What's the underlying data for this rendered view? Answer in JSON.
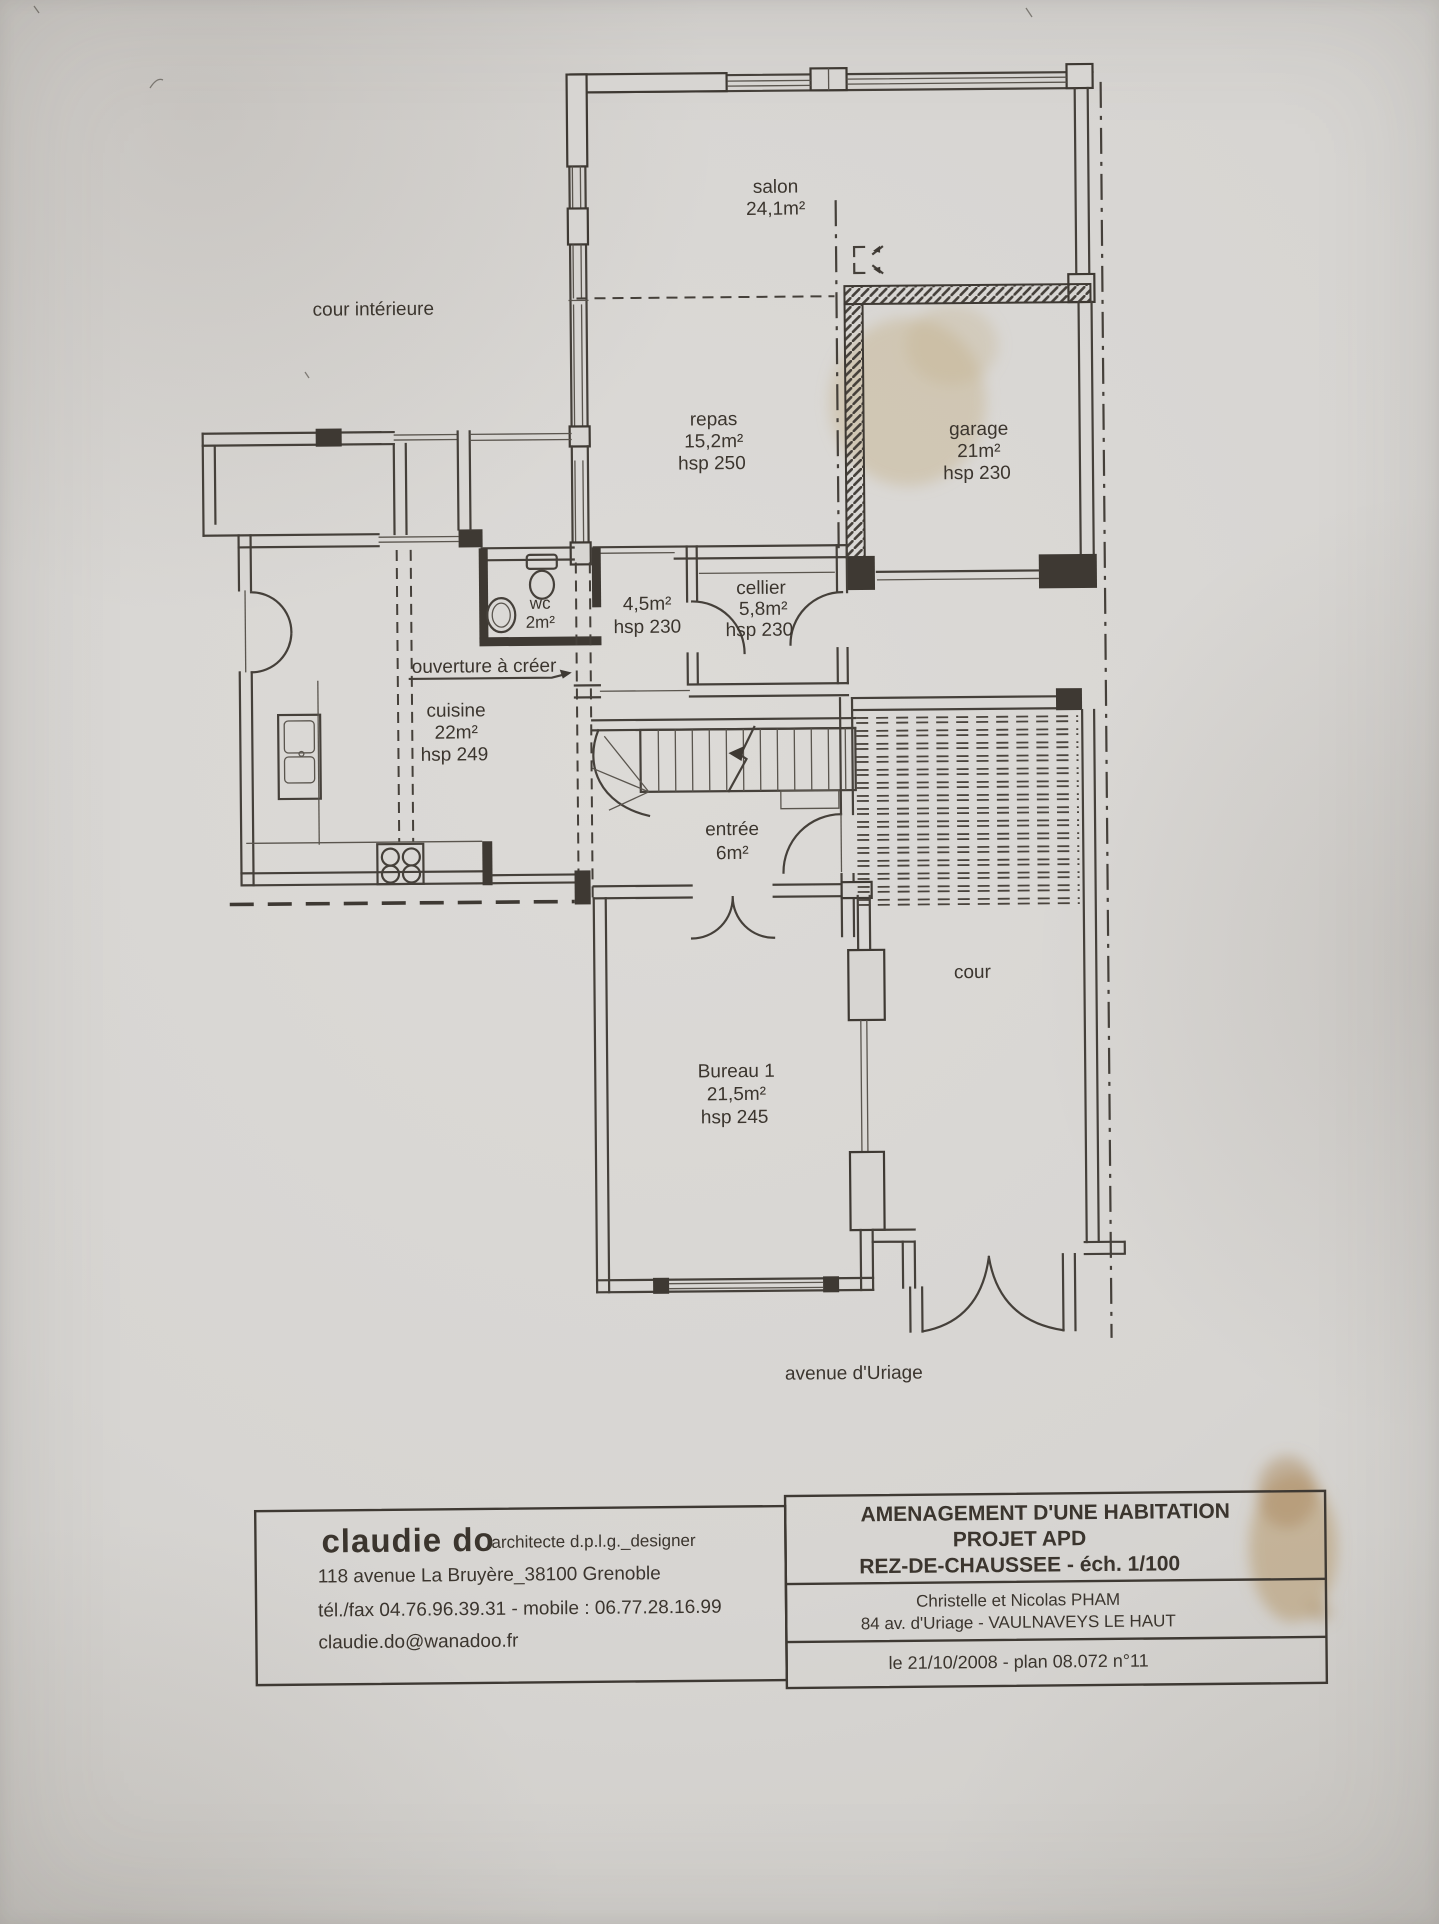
{
  "plan": {
    "annotations": {
      "cour_interieure": "cour intérieure",
      "ouverture": "ouverture à créer",
      "cour": "cour",
      "avenue": "avenue d'Uriage"
    },
    "rooms": {
      "salon": {
        "name": "salon",
        "area": "24,1m²"
      },
      "repas": {
        "name": "repas",
        "area": "15,2m²",
        "hsp": "hsp 250"
      },
      "garage": {
        "name": "garage",
        "area": "21m²",
        "hsp": "hsp 230"
      },
      "wc": {
        "name": "wc",
        "area": "2m²"
      },
      "degagement": {
        "area": "4,5m²",
        "hsp": "hsp 230"
      },
      "cellier": {
        "name": "cellier",
        "area": "5,8m²",
        "hsp": "hsp 230"
      },
      "cuisine": {
        "name": "cuisine",
        "area": "22m²",
        "hsp": "hsp 249"
      },
      "entree": {
        "name": "entrée",
        "area": "6m²"
      },
      "bureau1": {
        "name": "Bureau 1",
        "area": "21,5m²",
        "hsp": "hsp 245"
      }
    }
  },
  "title_block": {
    "architect": {
      "name": "claudie do",
      "title": "architecte d.p.l.g._designer",
      "address": "118 avenue La Bruyère_38100 Grenoble",
      "phone": "tél./fax 04.76.96.39.31 - mobile : 06.77.28.16.99",
      "email": "claudie.do@wanadoo.fr"
    },
    "project": {
      "title1": "AMENAGEMENT D'UNE HABITATION",
      "title2": "PROJET  APD",
      "title3": "REZ-DE-CHAUSSEE - éch. 1/100",
      "client_line1": "Christelle et Nicolas PHAM",
      "client_line2": "84 av. d'Uriage - VAULNAVEYS LE HAUT",
      "date_line": "le 21/10/2008 - plan 08.072 n°11"
    }
  },
  "colors": {
    "ink": "#3e3933",
    "paper": "#d7d5d2"
  }
}
